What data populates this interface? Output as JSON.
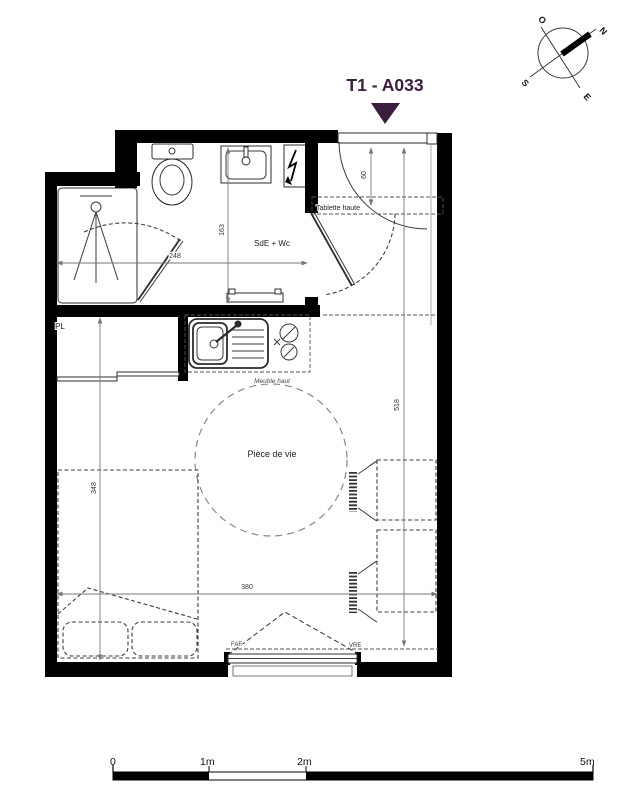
{
  "title": {
    "text": "T1 - A033"
  },
  "compass": {
    "north": "N",
    "west": "O",
    "south": "S",
    "east": "E"
  },
  "rooms": {
    "bathroom": "SdE + Wc",
    "closet": "PL",
    "living": "Pièce de vie"
  },
  "annotations": {
    "high_shelf": "Tablette haute",
    "high_cabinet": "Meuble haut",
    "window_type": "FAF",
    "shutter_type": "VRE"
  },
  "dimensions_cm": {
    "bathroom_width": "248",
    "bathroom_depth": "163",
    "entry_shelf_depth": "60",
    "living_length": "518",
    "sleeping_depth": "348",
    "living_width": "380"
  },
  "scale_bar": {
    "zero": "0",
    "one": "1m",
    "two": "2m",
    "five": "5m"
  },
  "colors": {
    "accent": "#3B1E3E",
    "walls": "#000000",
    "dimension_lines": "#777777"
  }
}
